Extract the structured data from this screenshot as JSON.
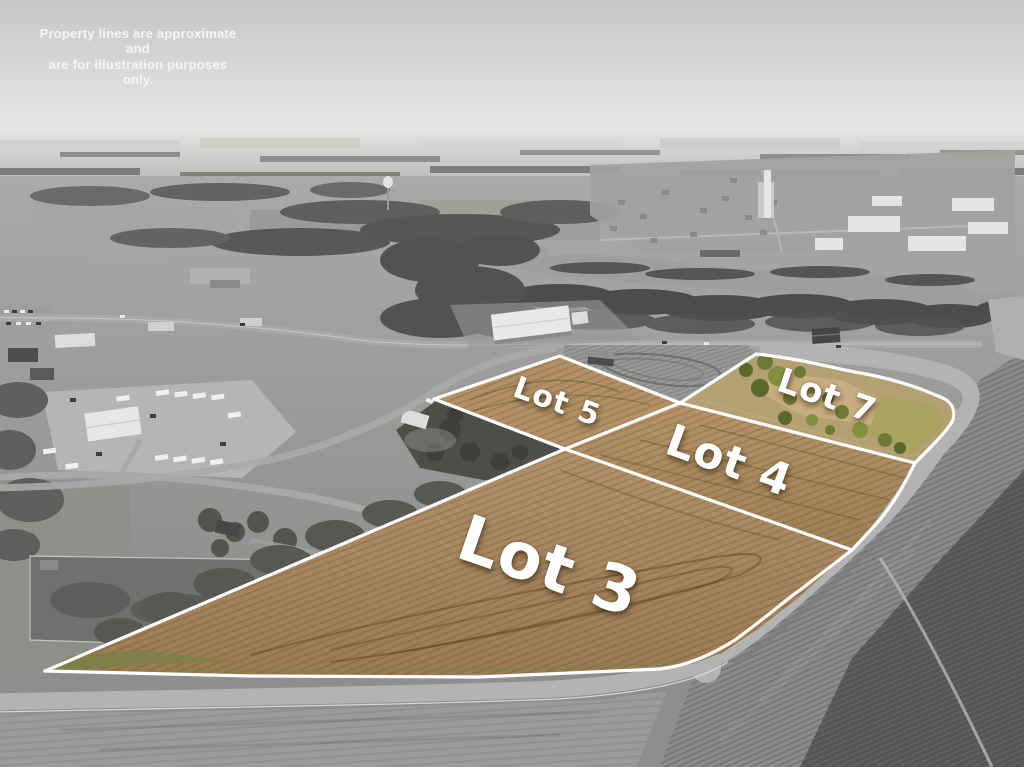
{
  "disclaimer": {
    "line1": "Property lines are approximate and",
    "line2": "are for illustration purposes only."
  },
  "lots": [
    {
      "id": "lot-3",
      "label": "Lot 3"
    },
    {
      "id": "lot-4",
      "label": "Lot 4"
    },
    {
      "id": "lot-5",
      "label": "Lot 5"
    },
    {
      "id": "lot-7",
      "label": "Lot 7"
    }
  ],
  "colors": {
    "lot_highlight_sepia": "#a98a60",
    "lot_boundary_line": "#ffffff",
    "label_text": "#ffffff",
    "sky_gray": "#d6d6d4",
    "landscape_gray": "#8e8e8c",
    "road_gray": "#b2b2b0",
    "dark_tilled_field": "#525250",
    "lot7_vegetation_green": "#77853c"
  }
}
